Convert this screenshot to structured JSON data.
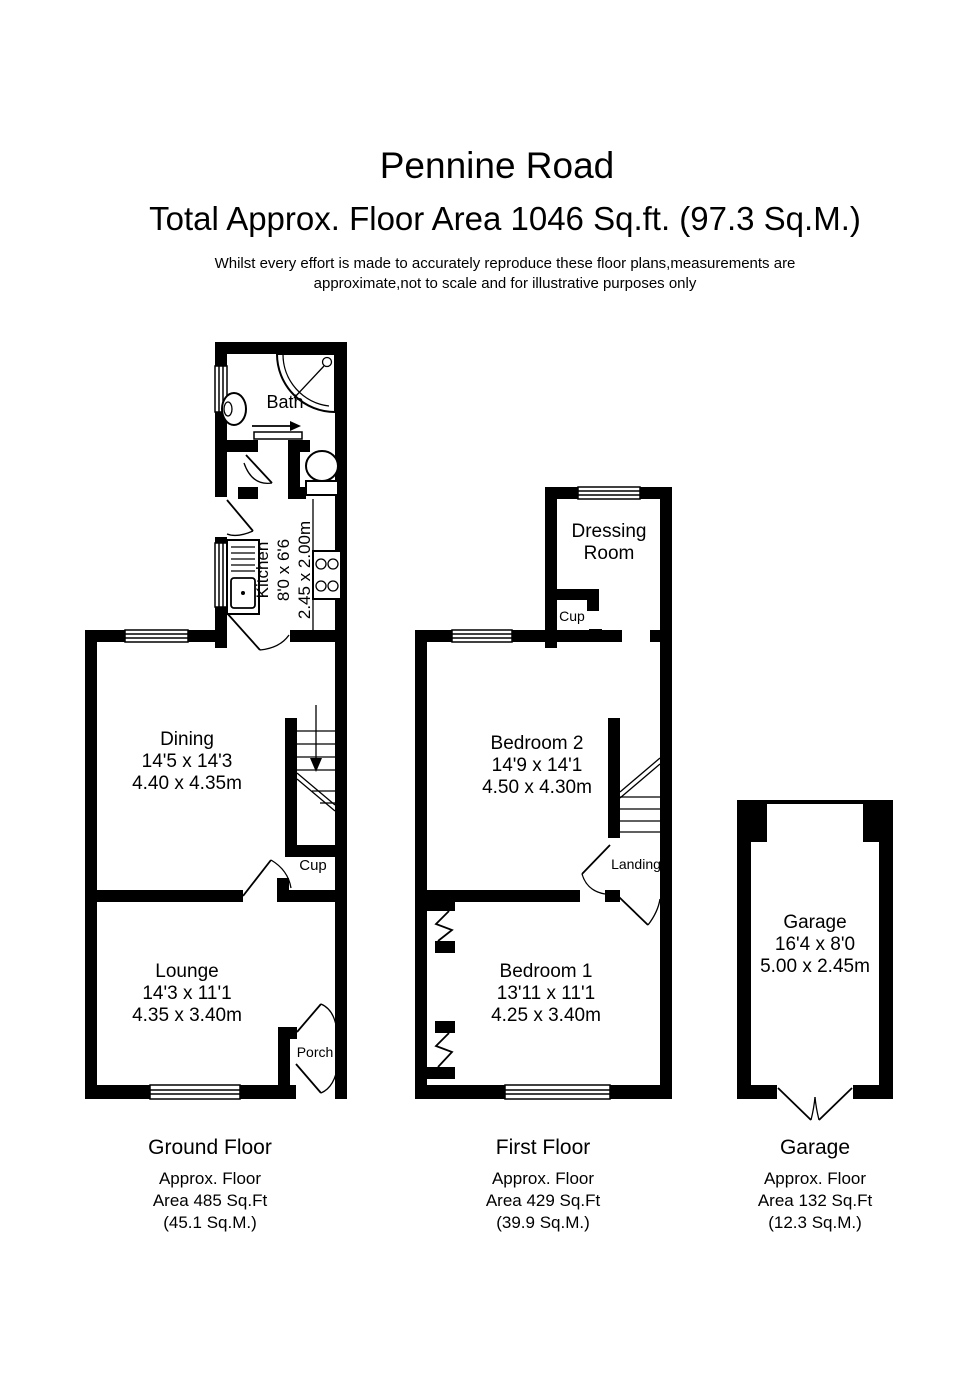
{
  "header": {
    "title": "Pennine Road",
    "subtitle": "Total Approx. Floor Area 1046 Sq.ft. (97.3 Sq.M.)",
    "disclaimer1": "Whilst every effort is made to accurately reproduce these floor plans,measurements are",
    "disclaimer2": "approximate,not to scale and for illustrative purposes only"
  },
  "colors": {
    "wall": "#000000",
    "background": "#ffffff",
    "text": "#000000"
  },
  "ground_floor": {
    "caption": {
      "title": "Ground Floor",
      "area1": "Approx. Floor",
      "area2": "Area 485 Sq.Ft",
      "area3": "(45.1 Sq.M.)"
    },
    "bath": {
      "name": "Bath"
    },
    "kitchen": {
      "name": "Kitchen",
      "dims_ft": "8'0 x 6'6",
      "dims_m": "2.45 x 2.00m"
    },
    "dining": {
      "name": "Dining",
      "dims_ft": "14'5 x 14'3",
      "dims_m": "4.40 x 4.35m"
    },
    "cupboard": {
      "name": "Cup"
    },
    "lounge": {
      "name": "Lounge",
      "dims_ft": "14'3 x 11'1",
      "dims_m": "4.35 x 3.40m"
    },
    "porch": {
      "name": "Porch"
    }
  },
  "first_floor": {
    "caption": {
      "title": "First Floor",
      "area1": "Approx. Floor",
      "area2": "Area 429 Sq.Ft",
      "area3": "(39.9 Sq.M.)"
    },
    "dressing_room": {
      "name_line1": "Dressing",
      "name_line2": "Room"
    },
    "cupboard": {
      "name": "Cup"
    },
    "bedroom2": {
      "name": "Bedroom 2",
      "dims_ft": "14'9 x 14'1",
      "dims_m": "4.50 x 4.30m"
    },
    "landing": {
      "name": "Landing"
    },
    "bedroom1": {
      "name": "Bedroom 1",
      "dims_ft": "13'11 x 11'1",
      "dims_m": "4.25 x 3.40m"
    }
  },
  "garage": {
    "caption": {
      "title": "Garage",
      "area1": "Approx. Floor",
      "area2": "Area 132 Sq.Ft",
      "area3": "(12.3 Sq.M.)"
    },
    "room": {
      "name": "Garage",
      "dims_ft": "16'4 x 8'0",
      "dims_m": "5.00 x 2.45m"
    }
  }
}
